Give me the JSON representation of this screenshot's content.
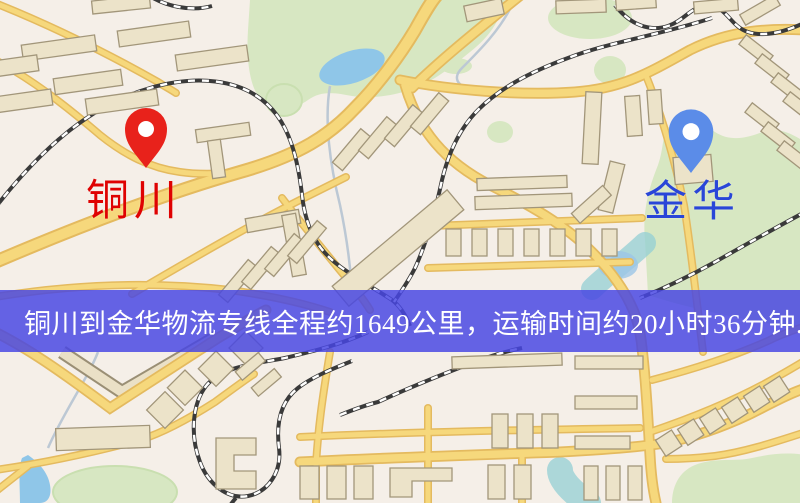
{
  "map": {
    "origin": {
      "label": "铜川",
      "pin": "red-location-pin"
    },
    "destination": {
      "label": "金华",
      "pin": "blue-location-pin"
    },
    "banner": {
      "text": "铜川到金华物流专线全程约1649公里，运输时间约20小时36分钟."
    },
    "route": {
      "from": "铜川",
      "to": "金华",
      "distance_km": "1649",
      "duration": "20小时36分钟"
    },
    "colors": {
      "background": "#f5efe8",
      "road": "#f6d87c",
      "road-casing": "#e4ba5f",
      "building-fill": "#ece3c9",
      "building-stroke": "#a2967a",
      "park": "#d7e7c2",
      "park-dark": "#c9dfb0",
      "water": "#8fc6e8",
      "river": "#93cfd4",
      "railway": "#3a3a3a",
      "stream": "#bcc8d4",
      "banner-bg": "rgba(72,70,226,0.84)",
      "banner-text": "#ffffff",
      "origin-label": "#df0202",
      "origin-pin": "#e8221b",
      "dest-label": "#2946d8",
      "dest-pin": "#5b8ce8"
    }
  }
}
